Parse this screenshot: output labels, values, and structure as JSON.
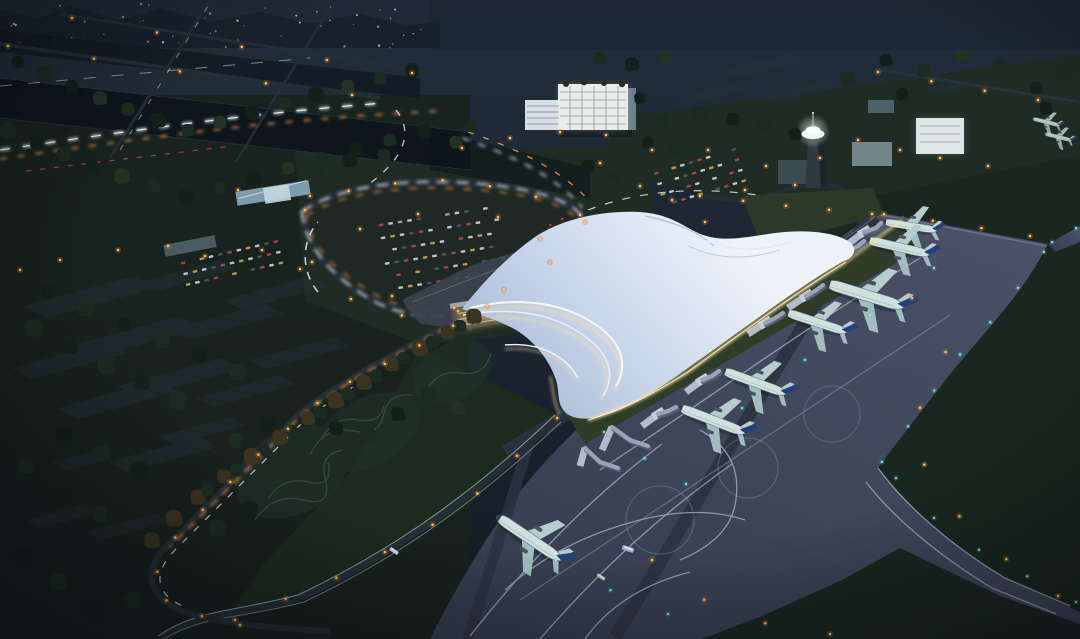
{
  "scene": {
    "type": "aerial-night-architectural-rendering",
    "subject": "airport-terminal-complex-at-dusk",
    "elements": [
      "city-skyline",
      "expressway-light-trails",
      "tree-lined-avenue",
      "approach-loop-road",
      "parking-lots",
      "office-building",
      "control-tower",
      "terminal-building",
      "flowing-white-roof",
      "jet-bridges",
      "gate-aircraft",
      "taxiing-aircraft",
      "apron",
      "taxiways",
      "grass-fields",
      "landscaped-gardens"
    ],
    "counts": {
      "gate_aircraft": 6,
      "taxiing_aircraft": 1,
      "distant_aircraft": 2,
      "jet_bridges": 8,
      "buses": 3
    }
  },
  "palette": {
    "base_top": "#222e3b",
    "base_bottom": "#131b25",
    "city_strip": "#1f2a36",
    "city_light": "#d7e2ec",
    "city_warm": "#e8c98c",
    "expressway": "#0e151d",
    "expressway2": "#121a23",
    "park_green": "#18221d",
    "mid_green": "#1f2c23",
    "airside_grass": "#1a2620",
    "lawn_green": "#2e3c28",
    "field_plot": "#243039",
    "apron_dark": "#343c4e",
    "apron_light": "#4b5268",
    "taxiway_line": "#aebdcf",
    "service_band": "#2b3240",
    "road_dark": "#242e35",
    "road_edge": "#9db3bb",
    "trail_white": "#eef1f5",
    "trail_orange": "#ff9d4a",
    "trail_red": "#d4483a",
    "lamp_amber": "#ffc069",
    "lamp_halo": "#c67b2e",
    "light_cyan": "#9df4f1",
    "cyan_halo": "#3fd9d6",
    "roof_light": "#eef3fa",
    "roof_mid": "#c4d2e8",
    "roof_shadow": "#9fb2cf",
    "glow_warm": "#ffe3a1",
    "facade_amber": "#e4cc8e",
    "glass_dark": "#2c3a50",
    "bridge_gray": "#9aa4b6",
    "concourse_gray": "#4a5260",
    "pod_gray": "#c6cdda",
    "plane_body": "#cfe0df",
    "plane_wing": "#a3bcbf",
    "plane_wing_hi": "#b7ccce",
    "plane_fin": "#24407c",
    "tower_glow": "#eef6fa",
    "building_lit": "#e6edf3",
    "building_gray": "#8fa3ad",
    "tree_dark": "#13201a",
    "tree_mid": "#1c2b21",
    "tree_green": "#243226",
    "tree_warm": "#3a331f",
    "garden_line": "#4d6457",
    "garden_bed": "#22322b",
    "flag_red": "#d03a2e",
    "bus_lavender": "#a9a0d6",
    "vignette": "#060b12",
    "car_red": "#b24a42",
    "car_white": "#cfd6da",
    "car_amber": "#caa457",
    "car_dark": "#4a5a66"
  }
}
